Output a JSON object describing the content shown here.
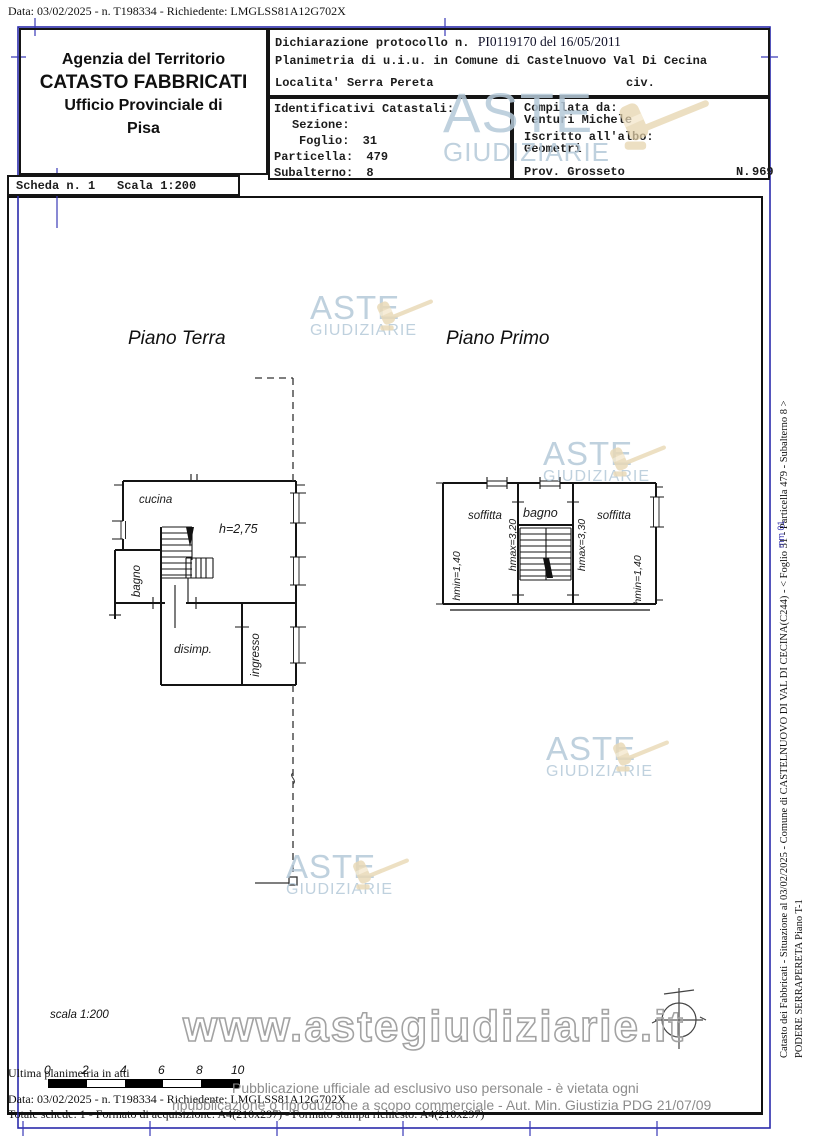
{
  "meta": {
    "top_line": "Data: 03/02/2025 - n. T198334 - Richiedente: LMGLSS81A12G702X",
    "ultima_line": "Ultima planimetria in atti",
    "bottom_date_line": "Data: 03/02/2025 - n. T198334 - Richiedente: LMGLSS81A12G702X",
    "bottom_totale_line": "Totale schede: 1 - Formato di acquisizione: A4(210x297) - Formato stampa richiesto: A4(210x297)"
  },
  "header": {
    "agency": {
      "line1": "Agenzia del Territorio",
      "line2": "CATASTO FABBRICATI",
      "line3": "Ufficio Provinciale di",
      "line4": "Pisa"
    },
    "scheda": {
      "label": "Scheda n. 1",
      "scala": "Scala 1:200"
    },
    "dichiarazione": {
      "prefix": "Dichiarazione protocollo n.",
      "stamp": "PI0119170 del 16/05/2011",
      "line2": "Planimetria di u.i.u. in Comune di Castelnuovo Val Di Cecina",
      "line3": "Localita' Serra Pereta",
      "civ": "civ."
    },
    "identificativi": {
      "title": "Identificativi Catastali:",
      "sezione_label": "Sezione:",
      "foglio_label": "Foglio:",
      "foglio": "31",
      "particella_label": "Particella:",
      "particella": "479",
      "subalterno_label": "Subalterno:",
      "subalterno": "8"
    },
    "compilata": {
      "label": "Compilata da:",
      "name": "Venturi Michele",
      "albo_label": "Iscritto all'albo:",
      "albo": "Geometri",
      "prov": "Prov. Grosseto",
      "n_label": "N.",
      "n_value": "969"
    }
  },
  "plan": {
    "floor_ground_title": "Piano Terra",
    "floor_first_title": "Piano Primo",
    "ground": {
      "cucina": "cucina",
      "height": "h=2,75",
      "bagno": "bagno",
      "disimp": "disimp.",
      "ingresso": "ingresso"
    },
    "first": {
      "soffitta_left": "soffitta",
      "bagno": "bagno",
      "soffitta_right": "soffitta",
      "hmin_left": "hmin=1,40",
      "hmax_left": "hmax=3,20",
      "hmax_right": "hmax=3,30",
      "hmin_right": "hmin=1,40"
    },
    "scala_note": "scala 1:200"
  },
  "scalebar": {
    "labels": [
      "0",
      "2",
      "4",
      "6",
      "8",
      "10"
    ]
  },
  "watermark": {
    "line1": "ASTE",
    "line2": "GIUDIZIARIE",
    "url": "www.astegiudiziarie.it",
    "text_color": "#b5c9d9",
    "gavel_color": "#e6d3ab"
  },
  "disclaimer": {
    "line1": "Pubblicazione ufficiale ad esclusivo uso personale - è vietata ogni",
    "line2": "ripubblicazione o riproduzione a scopo commerciale - Aut. Min. Giustizia PDG 21/07/09"
  },
  "side": {
    "line1": "Catasto dei Fabbricati - Situazione al 03/02/2025 - Comune di CASTELNUOVO DI VAL DI CECINA(C244) - < Foglio 31 - Particella 479 - Subalterno 8 >",
    "line2": "PODERE SERRAPERETA Piano T-1",
    "blue_mark": "mm 01"
  },
  "colors": {
    "frame_blue": "#2b2bab",
    "wall": "#141414"
  }
}
